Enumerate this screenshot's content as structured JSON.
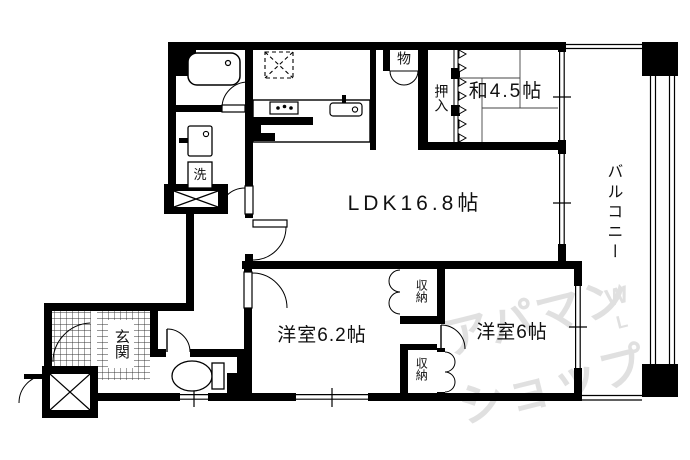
{
  "rooms": {
    "ldk": {
      "label": "LDK16.8帖"
    },
    "japanese_room": {
      "label": "和4.5帖"
    },
    "western_room_62": {
      "label": "洋室6.2帖"
    },
    "western_room_6": {
      "label": "洋室6帖"
    },
    "balcony": {
      "label": "バルコニー"
    },
    "entrance": {
      "label": "玄関"
    }
  },
  "storage": {
    "mono": {
      "label": "物"
    },
    "oshiire": {
      "label": "押入"
    },
    "shuno_top": {
      "label": "収納"
    },
    "shuno_bottom": {
      "label": "収納"
    }
  },
  "fixtures": {
    "laundry": {
      "label": "洗"
    }
  },
  "watermark": {
    "line1": "アパマン",
    "line2": "ショップ",
    "mark_top": "W",
    "mark_bottom": "L",
    "color": "#e0e0e0"
  },
  "colors": {
    "wall": "#000000",
    "background": "#ffffff",
    "text": "#111111"
  }
}
